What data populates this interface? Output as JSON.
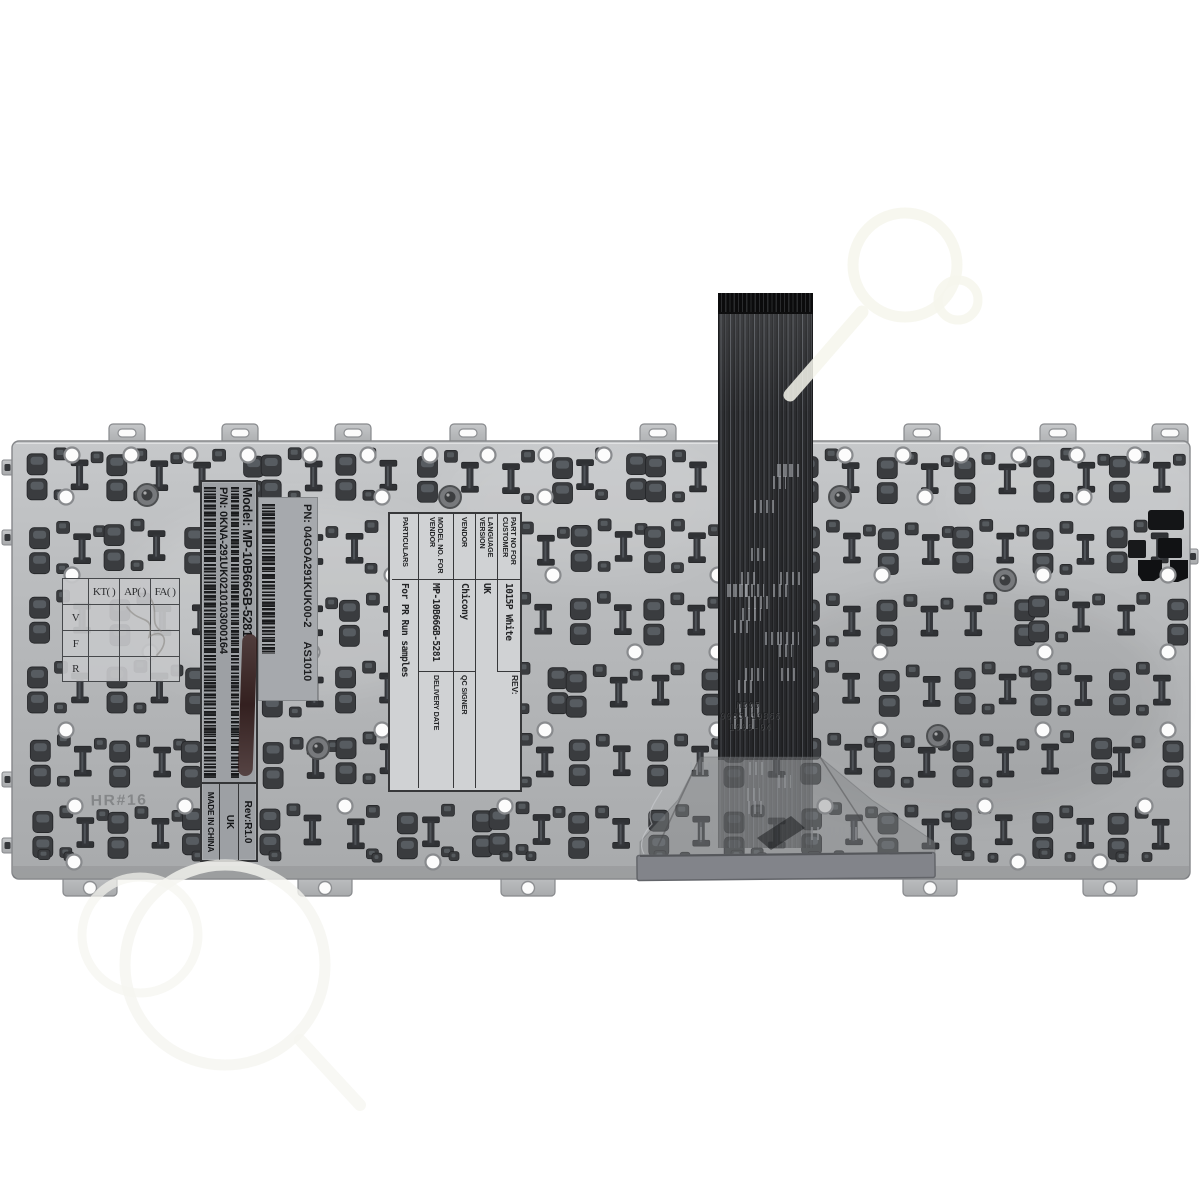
{
  "photo": {
    "model_sticker": {
      "model": "Model: MP-10B66GB-5281",
      "part_number": "P/N: 0KNA-291UK0210103000164",
      "revision": "Rev:R1.0",
      "language": "UK",
      "origin": "MADE IN CHINA"
    },
    "vendor_sticker": {
      "part_number": "PN: 04GOA291KUK00-2",
      "batch": "AS1010"
    },
    "spec_label": {
      "part_no_header": "PART NO FOR CUSTOMER",
      "part_no_value": "1015P White",
      "rev_header": "REV:",
      "language_header": "LANGUAGE VERSION",
      "language_value": "UK",
      "vendor_header": "VENDOR",
      "vendor_value": "Chicony",
      "qc_header": "QC SIGNER",
      "model_header": "MODEL NO. FOR VENDOR",
      "model_value": "MP-10B66GB-5281",
      "delivery_header": "DELIVERY DATE",
      "particulars_header": "PARTICULARS",
      "particulars_value": "For PR Run samples"
    },
    "qc_grid": {
      "col_headers": [
        "KT( )",
        "AP( )",
        "FA( )"
      ],
      "row_headers": [
        "V",
        "F",
        "R"
      ]
    },
    "stamps": {
      "plate_code": "HR#16",
      "cable_line1": "MB05",
      "cable_line2": "0085-10B66",
      "cable_line3": "1009-04"
    },
    "colors": {
      "background": "#ffffff",
      "plate": "#b7b9bb",
      "clip_dark": "#3a3c3f",
      "cable": "#2b2c2f",
      "sticker_gray": "#9da0a4",
      "label_light": "#d0d2d4",
      "smear": "#3a1d1b"
    }
  }
}
